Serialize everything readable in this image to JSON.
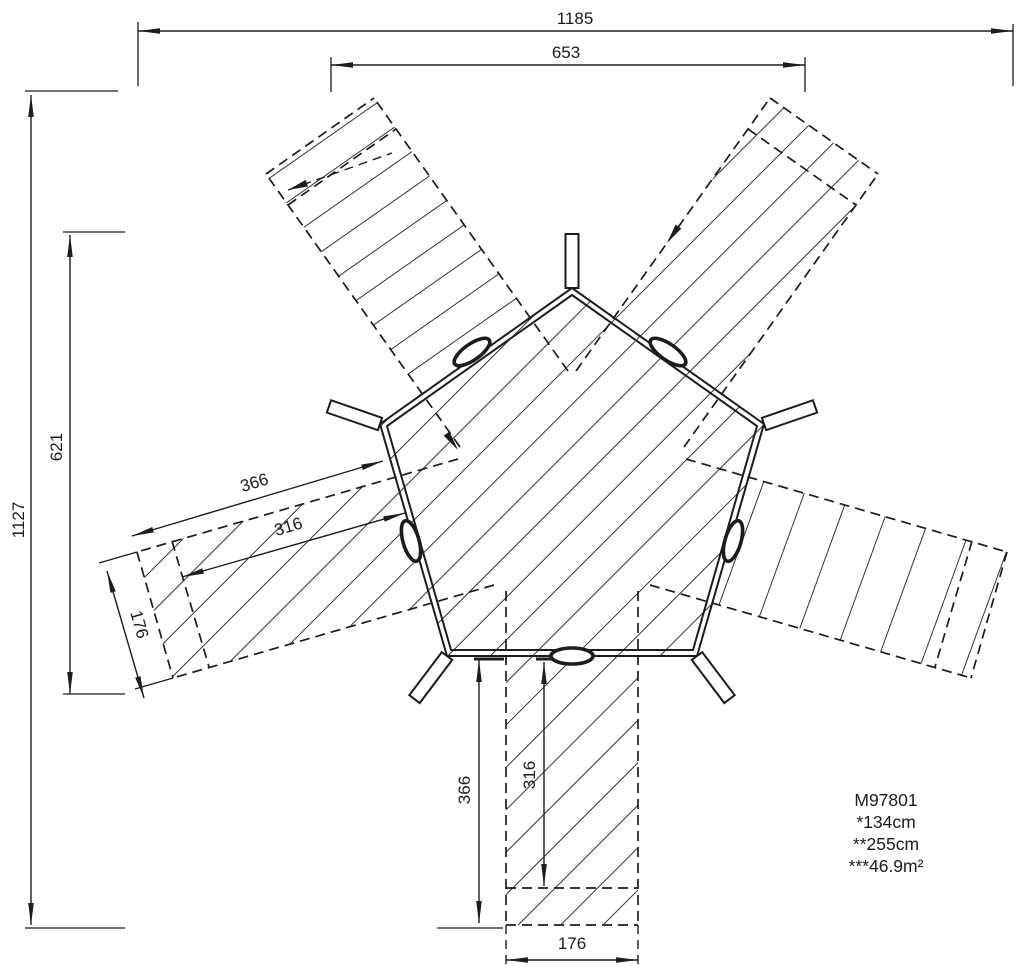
{
  "drawing": {
    "dimensions": {
      "overall_width": "1185",
      "top_opening": "653",
      "overall_height": "1127",
      "upper_left_height": "621",
      "left_arm": {
        "length": "366",
        "inner_length": "316",
        "width": "176"
      },
      "bottom_arm": {
        "length": "366",
        "inner_length": "316",
        "width": "176"
      }
    },
    "legend": {
      "model": "M97801",
      "line1": "*134cm",
      "line2": "**255cm",
      "line3": "***46.9m²"
    },
    "colors": {
      "line": "#1c1c1c",
      "background": "#ffffff"
    }
  }
}
